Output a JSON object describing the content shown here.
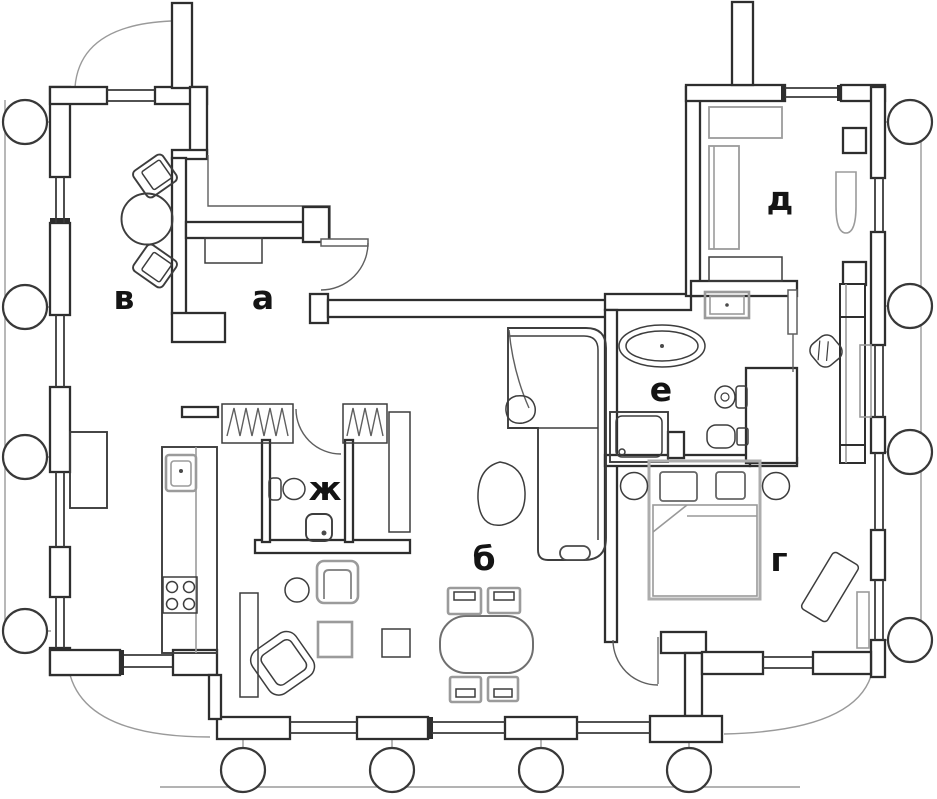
{
  "plan": {
    "rooms": [
      {
        "id": "v",
        "label": "в"
      },
      {
        "id": "a",
        "label": "а"
      },
      {
        "id": "zh",
        "label": "ж"
      },
      {
        "id": "b",
        "label": "б"
      },
      {
        "id": "d",
        "label": "д"
      },
      {
        "id": "e",
        "label": "е"
      },
      {
        "id": "g",
        "label": "г"
      }
    ],
    "colors": {
      "wall": "#2e2e2e",
      "furniture_dark": "#3d3d3d",
      "furniture_gray": "#9b9b9b",
      "label": "#141414",
      "background": "#ffffff"
    }
  }
}
